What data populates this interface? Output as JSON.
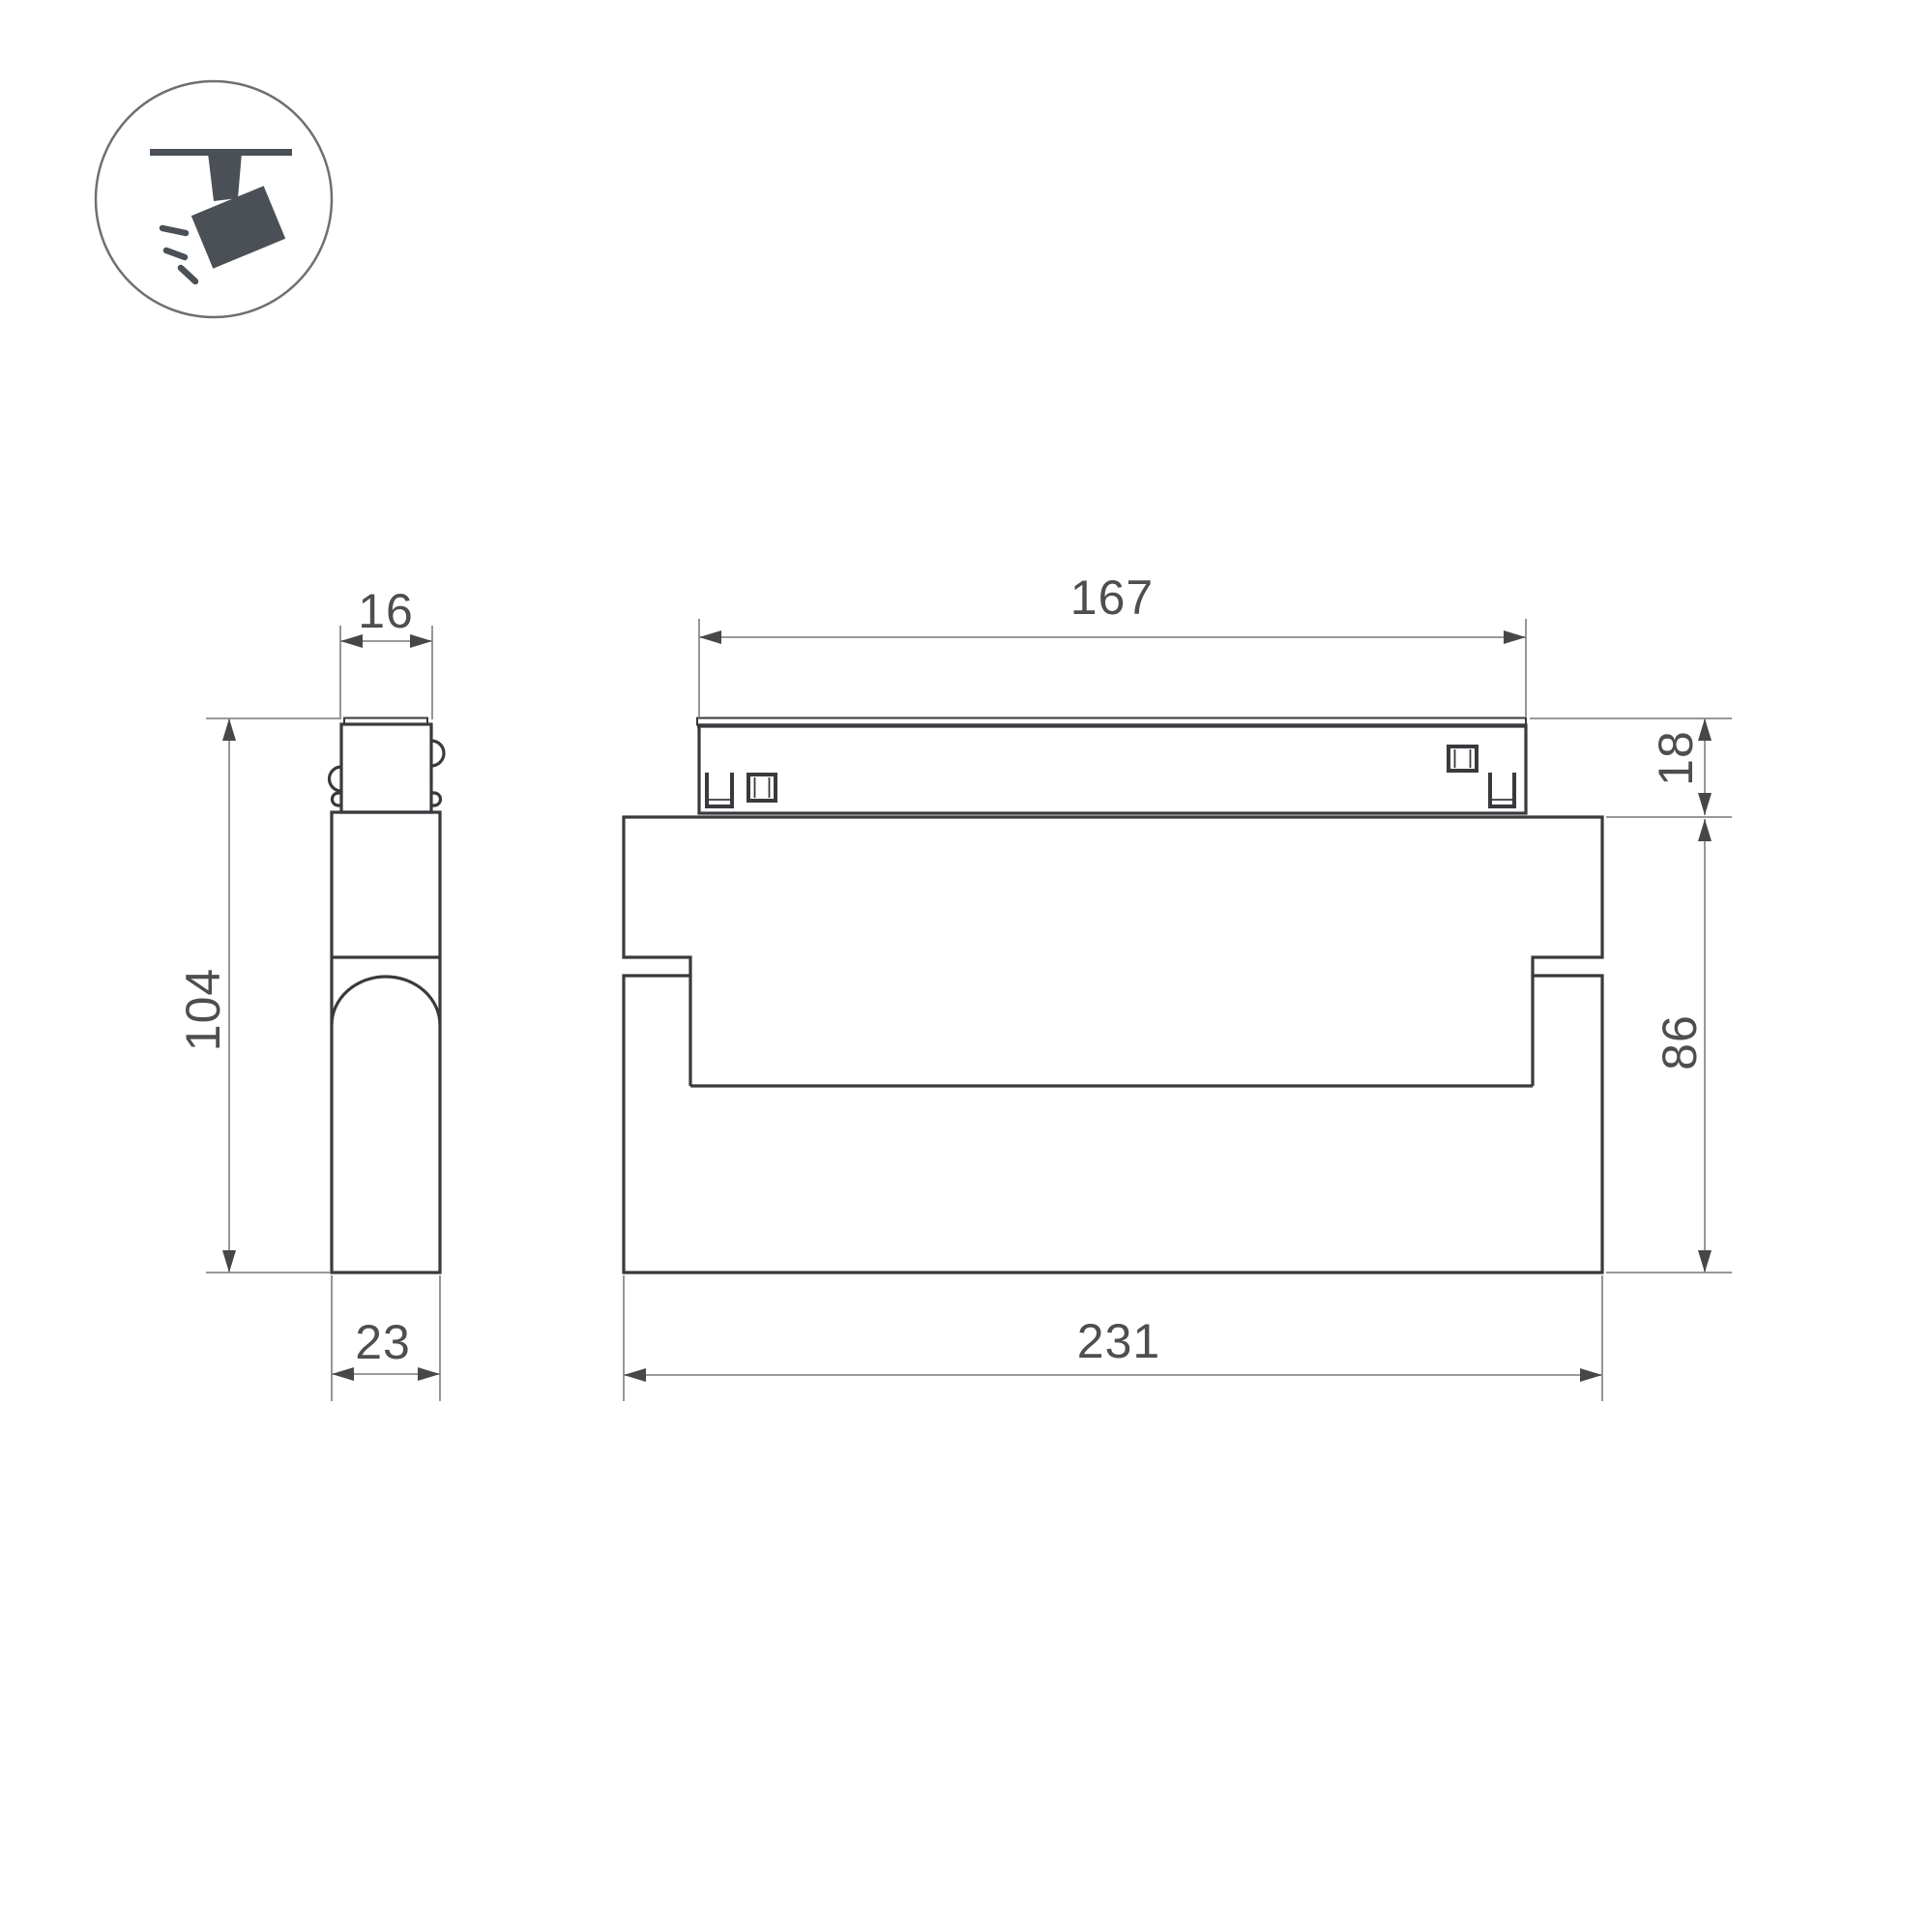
{
  "drawing": {
    "kind": "technical-dimension-drawing",
    "views": [
      "side-view",
      "front-view"
    ],
    "badge_icon": "ceiling-track-spotlight-icon"
  },
  "dims": {
    "d16": {
      "value": "16",
      "orientation": "horizontal",
      "view": "side",
      "feature": "track-connector-width"
    },
    "d104": {
      "value": "104",
      "orientation": "vertical",
      "view": "side",
      "feature": "overall-height"
    },
    "d23": {
      "value": "23",
      "orientation": "horizontal",
      "view": "side",
      "feature": "body-depth"
    },
    "d167": {
      "value": "167",
      "orientation": "horizontal",
      "view": "front",
      "feature": "track-connector-length"
    },
    "d18": {
      "value": "18",
      "orientation": "vertical",
      "view": "front",
      "feature": "connector-height"
    },
    "d86": {
      "value": "86",
      "orientation": "vertical",
      "view": "front",
      "feature": "body-height"
    },
    "d231": {
      "value": "231",
      "orientation": "horizontal",
      "view": "front",
      "feature": "body-length"
    }
  },
  "style": {
    "colors": {
      "bg": "#ffffff",
      "outline": "#3a3a3e",
      "dim": "#8c8c8c",
      "ext": "#8a8a8a",
      "arrow": "#474747",
      "label": "#4e4e50",
      "icon": "#4a5055",
      "circle": "#6f6f6f"
    }
  }
}
